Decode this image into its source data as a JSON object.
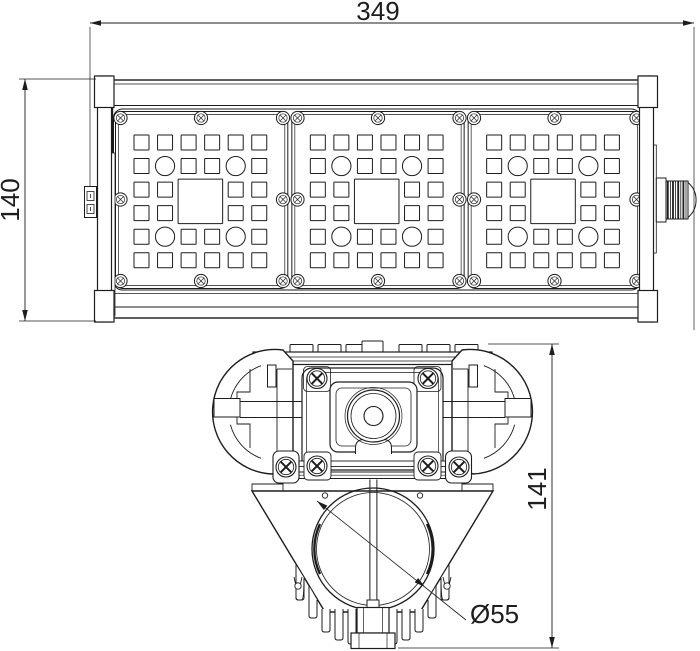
{
  "canvas": {
    "background": "#ffffff",
    "line_color": "#1d1d1d"
  },
  "dimensions": {
    "overall_width": {
      "label": "349"
    },
    "overall_height": {
      "label": "140"
    },
    "section_height": {
      "label": "141"
    },
    "tube_diameter": {
      "label": "Ø55"
    }
  }
}
